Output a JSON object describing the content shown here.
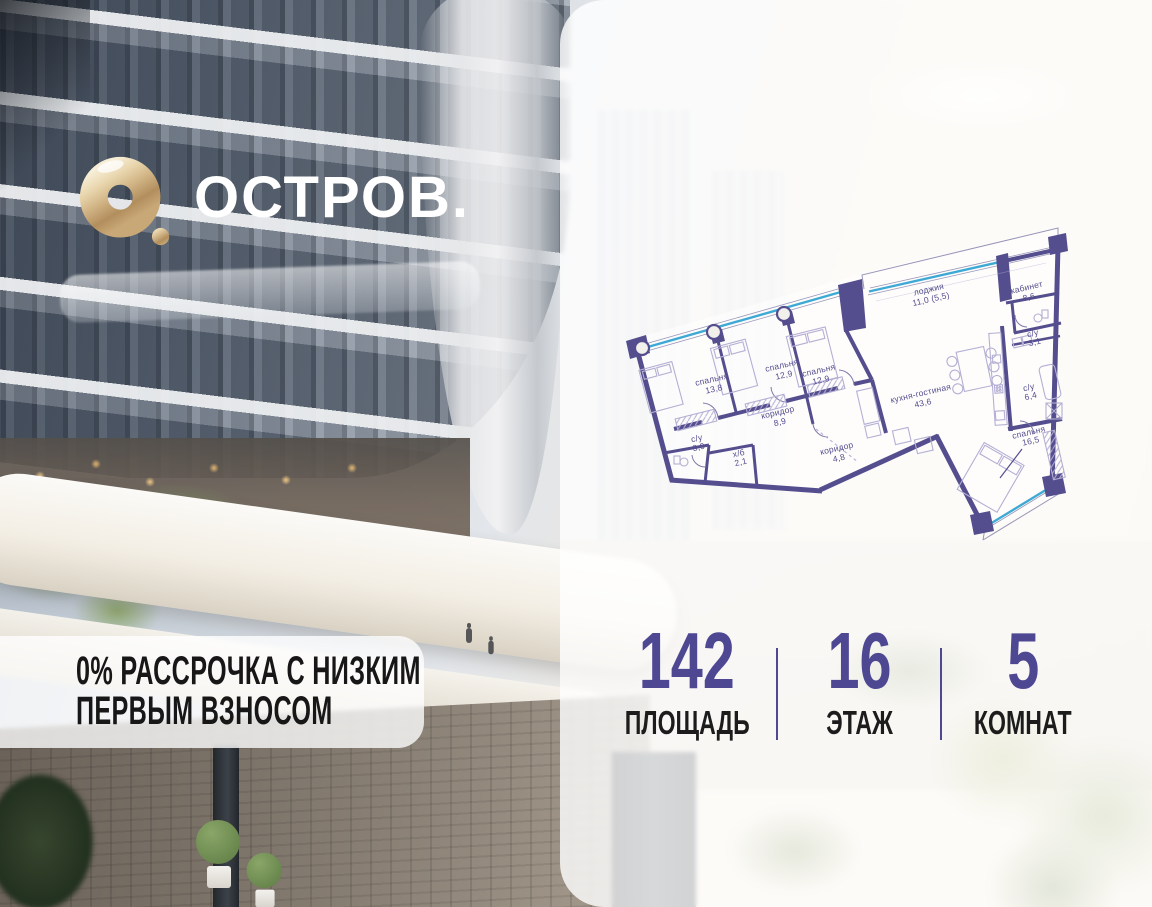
{
  "logo": {
    "brand": "ОСТРОВ."
  },
  "banner": {
    "line1": "0% РАССРОЧКА С НИЗКИМ",
    "line2": "ПЕРВЫМ ВЗНОСОМ"
  },
  "stats": {
    "area": {
      "value": "142",
      "label": "ПЛОЩАДЬ"
    },
    "floor": {
      "value": "16",
      "label": "ЭТАЖ"
    },
    "rooms": {
      "value": "5",
      "label": "КОМНАТ"
    }
  },
  "plan": {
    "rooms": [
      {
        "name": "спальня",
        "area": "13,8"
      },
      {
        "name": "спальня",
        "area": "12,9"
      },
      {
        "name": "спальня",
        "area": "12,9"
      },
      {
        "name": "лоджия",
        "area": "11,0 (5,5)"
      },
      {
        "name": "кабинет",
        "area": "8,6"
      },
      {
        "name": "с/у",
        "area": "3,1"
      },
      {
        "name": "с/у",
        "area": "6,4"
      },
      {
        "name": "кухня-гостиная",
        "area": "43,6"
      },
      {
        "name": "коридор",
        "area": "8,9"
      },
      {
        "name": "с/у",
        "area": "3,9"
      },
      {
        "name": "х/б",
        "area": "2,1"
      },
      {
        "name": "коридор",
        "area": "4,8"
      },
      {
        "name": "спальня",
        "area": "16,5"
      }
    ]
  },
  "colors": {
    "wall": "#554e8e",
    "glazing": "#3fa9d5",
    "accent": "#4e4893",
    "gold": "#cbb287"
  }
}
